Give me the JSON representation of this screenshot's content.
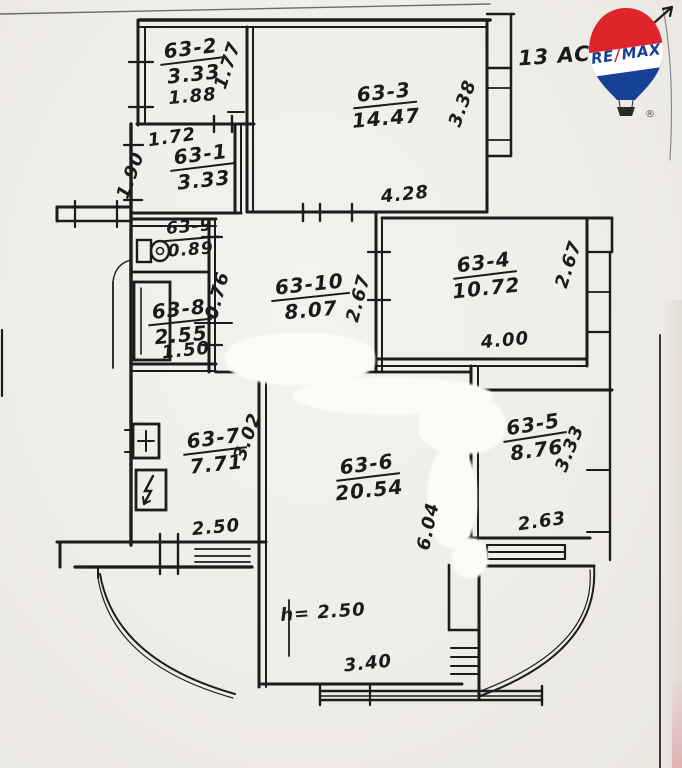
{
  "logo": {
    "re": "RE",
    "slash": "/",
    "max": "MAX",
    "registered": "®"
  },
  "note": {
    "text": "13 AC"
  },
  "rooms": {
    "r63_1": {
      "id": "63-1",
      "area": "3.33"
    },
    "r63_2": {
      "id": "63-2",
      "area": "3.33"
    },
    "r63_3": {
      "id": "63-3",
      "area": "14.47"
    },
    "r63_4": {
      "id": "63-4",
      "area": "10.72"
    },
    "r63_5": {
      "id": "63-5",
      "area": "8.76"
    },
    "r63_6": {
      "id": "63-6",
      "area": "20.54"
    },
    "r63_7": {
      "id": "63-7",
      "area": "7.71"
    },
    "r63_8": {
      "id": "63-8",
      "area": "2.55"
    },
    "r63_9": {
      "id": "63-9",
      "area": "0.89"
    },
    "r63_10": {
      "id": "63-10",
      "area": "8.07"
    }
  },
  "dimensions": {
    "d1_88": "1.88",
    "d1_77": "1.77",
    "d1_72": "1.72",
    "d1_90": "1.90",
    "d4_28": "4.28",
    "d3_38": "3.38",
    "d0_76": "0.76",
    "d1_50": "1.50",
    "d4_00": "4.00",
    "d2_67_left": "2.67",
    "d2_67_right": "2.67",
    "d2_50_kitchen": "2.50",
    "d3_02": "3.02",
    "d6_04": "6.04",
    "d3_40": "3.40",
    "d3_33_side": "3.33",
    "d2_63": "2.63",
    "height_note": "h= 2.50"
  },
  "colors": {
    "ink": "#1c1c1c",
    "paper": "#f1efeb",
    "remax_red": "#e0242c",
    "remax_blue": "#164194"
  }
}
